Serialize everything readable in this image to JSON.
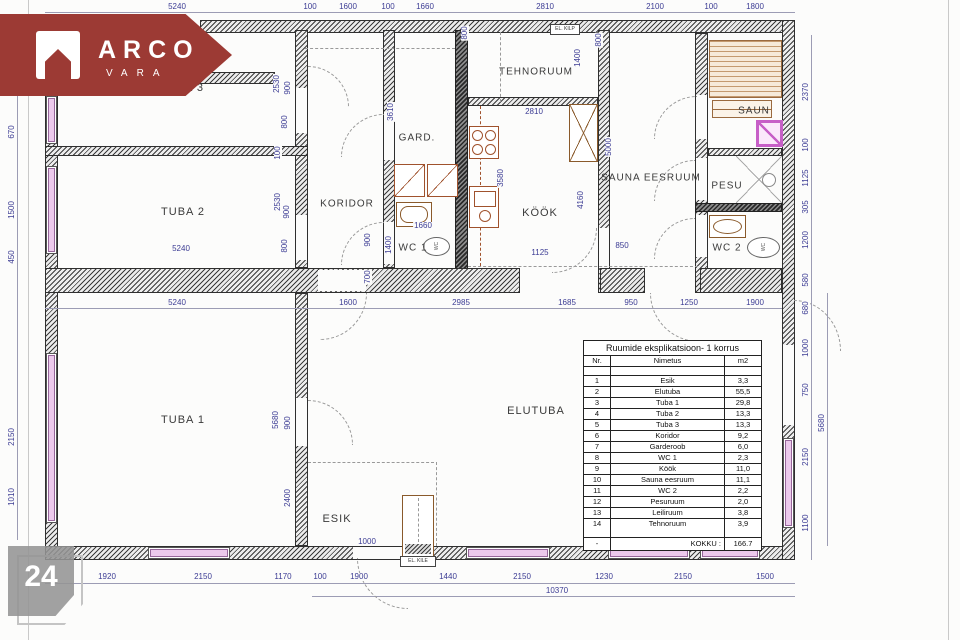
{
  "logo": {
    "brand": "ARCO",
    "sub": "VARA"
  },
  "badge": {
    "number": "24"
  },
  "annotations": {
    "el_kilp": "EL. KILP",
    "el_kile": "EL. KILE",
    "wc1_toilet": "WC",
    "wc2_toilet": "WC"
  },
  "rooms": [
    {
      "label": "TUBA 3",
      "x": 182,
      "y": 88,
      "s": 11
    },
    {
      "label": "TUBA 2",
      "x": 183,
      "y": 212,
      "s": 11
    },
    {
      "label": "TUBA 1",
      "x": 183,
      "y": 420,
      "s": 11
    },
    {
      "label": "ELUTUBA",
      "x": 536,
      "y": 411,
      "s": 11
    },
    {
      "label": "ESIK",
      "x": 337,
      "y": 519,
      "s": 11
    },
    {
      "label": "KORIDOR",
      "x": 347,
      "y": 204,
      "s": 10
    },
    {
      "label": "GARD.",
      "x": 417,
      "y": 138,
      "s": 10
    },
    {
      "label": "WC 1",
      "x": 413,
      "y": 248,
      "s": 10
    },
    {
      "label": "KÖÖK",
      "x": 540,
      "y": 213,
      "s": 11
    },
    {
      "label": "TEHNORUUM",
      "x": 536,
      "y": 72,
      "s": 10
    },
    {
      "label": "SAUNA EESRUUM",
      "x": 651,
      "y": 178,
      "s": 10
    },
    {
      "label": "SAUN",
      "x": 754,
      "y": 111,
      "s": 10
    },
    {
      "label": "PESU",
      "x": 727,
      "y": 186,
      "s": 10
    },
    {
      "label": "WC 2",
      "x": 727,
      "y": 248,
      "s": 10
    }
  ],
  "dimensions": [
    {
      "t": "5240",
      "x": 177,
      "y": 7
    },
    {
      "t": "100",
      "x": 310,
      "y": 7
    },
    {
      "t": "1600",
      "x": 348,
      "y": 7
    },
    {
      "t": "100",
      "x": 388,
      "y": 7
    },
    {
      "t": "1660",
      "x": 425,
      "y": 7
    },
    {
      "t": "2810",
      "x": 545,
      "y": 7
    },
    {
      "t": "2100",
      "x": 655,
      "y": 7
    },
    {
      "t": "100",
      "x": 711,
      "y": 7
    },
    {
      "t": "1800",
      "x": 755,
      "y": 7
    },
    {
      "t": "5240",
      "x": 177,
      "y": 303
    },
    {
      "t": "1600",
      "x": 348,
      "y": 303
    },
    {
      "t": "2985",
      "x": 461,
      "y": 303
    },
    {
      "t": "1685",
      "x": 567,
      "y": 303
    },
    {
      "t": "950",
      "x": 631,
      "y": 303
    },
    {
      "t": "1250",
      "x": 689,
      "y": 303
    },
    {
      "t": "1900",
      "x": 755,
      "y": 303
    },
    {
      "t": "1920",
      "x": 107,
      "y": 577
    },
    {
      "t": "2150",
      "x": 203,
      "y": 577
    },
    {
      "t": "1170",
      "x": 283,
      "y": 577
    },
    {
      "t": "100",
      "x": 320,
      "y": 577
    },
    {
      "t": "1900",
      "x": 359,
      "y": 577
    },
    {
      "t": "1440",
      "x": 448,
      "y": 577
    },
    {
      "t": "2150",
      "x": 522,
      "y": 577
    },
    {
      "t": "1230",
      "x": 604,
      "y": 577
    },
    {
      "t": "2150",
      "x": 683,
      "y": 577
    },
    {
      "t": "1500",
      "x": 765,
      "y": 577
    },
    {
      "t": "10370",
      "x": 557,
      "y": 591
    },
    {
      "t": "670",
      "x": 12,
      "y": 132,
      "r": 1
    },
    {
      "t": "1500",
      "x": 12,
      "y": 210,
      "r": 1
    },
    {
      "t": "450",
      "x": 12,
      "y": 257,
      "r": 1
    },
    {
      "t": "2150",
      "x": 12,
      "y": 437,
      "r": 1
    },
    {
      "t": "1010",
      "x": 12,
      "y": 497,
      "r": 1
    },
    {
      "t": "2370",
      "x": 806,
      "y": 92,
      "r": 1
    },
    {
      "t": "100",
      "x": 806,
      "y": 145,
      "r": 1
    },
    {
      "t": "1125",
      "x": 806,
      "y": 178,
      "r": 1
    },
    {
      "t": "305",
      "x": 806,
      "y": 207,
      "r": 1
    },
    {
      "t": "1200",
      "x": 806,
      "y": 240,
      "r": 1
    },
    {
      "t": "580",
      "x": 806,
      "y": 280,
      "r": 1
    },
    {
      "t": "680",
      "x": 806,
      "y": 308,
      "r": 1
    },
    {
      "t": "1000",
      "x": 806,
      "y": 348,
      "r": 1
    },
    {
      "t": "750",
      "x": 806,
      "y": 390,
      "r": 1
    },
    {
      "t": "2150",
      "x": 806,
      "y": 457,
      "r": 1
    },
    {
      "t": "1100",
      "x": 806,
      "y": 523,
      "r": 1
    },
    {
      "t": "5680",
      "x": 822,
      "y": 423,
      "r": 1
    },
    {
      "t": "2530",
      "x": 277,
      "y": 84,
      "r": 1
    },
    {
      "t": "900",
      "x": 288,
      "y": 88,
      "r": 1
    },
    {
      "t": "800",
      "x": 285,
      "y": 122,
      "r": 1
    },
    {
      "t": "100",
      "x": 278,
      "y": 153,
      "r": 1
    },
    {
      "t": "2530",
      "x": 278,
      "y": 202,
      "r": 1
    },
    {
      "t": "900",
      "x": 287,
      "y": 212,
      "r": 1
    },
    {
      "t": "800",
      "x": 285,
      "y": 246,
      "r": 1
    },
    {
      "t": "5680",
      "x": 276,
      "y": 420,
      "r": 1
    },
    {
      "t": "900",
      "x": 288,
      "y": 423,
      "r": 1
    },
    {
      "t": "2400",
      "x": 288,
      "y": 498,
      "r": 1
    },
    {
      "t": "900",
      "x": 368,
      "y": 240,
      "r": 1
    },
    {
      "t": "700",
      "x": 368,
      "y": 277,
      "r": 1
    },
    {
      "t": "1400",
      "x": 389,
      "y": 245,
      "r": 1
    },
    {
      "t": "3610",
      "x": 391,
      "y": 112,
      "r": 1
    },
    {
      "t": "3580",
      "x": 501,
      "y": 178,
      "r": 1
    },
    {
      "t": "4160",
      "x": 581,
      "y": 200,
      "r": 1
    },
    {
      "t": "5000",
      "x": 609,
      "y": 147,
      "r": 1
    },
    {
      "t": "1400",
      "x": 578,
      "y": 58,
      "r": 1
    },
    {
      "t": "800",
      "x": 465,
      "y": 33,
      "r": 1
    },
    {
      "t": "800",
      "x": 599,
      "y": 40,
      "r": 1
    },
    {
      "t": "1660",
      "x": 423,
      "y": 226
    },
    {
      "t": "1125",
      "x": 540,
      "y": 253
    },
    {
      "t": "2810",
      "x": 534,
      "y": 112
    },
    {
      "t": "850",
      "x": 622,
      "y": 246
    },
    {
      "t": "1000",
      "x": 367,
      "y": 542
    },
    {
      "t": "5240",
      "x": 181,
      "y": 249
    }
  ],
  "table": {
    "title": "Ruumide eksplikatsioon- 1 korrus",
    "headers": [
      "Nr.",
      "Nimetus",
      "m2"
    ],
    "rows": [
      [
        "1",
        "Esik",
        "3,3"
      ],
      [
        "2",
        "Elutuba",
        "55,5"
      ],
      [
        "3",
        "Tuba 1",
        "29,8"
      ],
      [
        "4",
        "Tuba 2",
        "13,3"
      ],
      [
        "5",
        "Tuba 3",
        "13,3"
      ],
      [
        "6",
        "Koridor",
        "9,2"
      ],
      [
        "7",
        "Garderoob",
        "6,0"
      ],
      [
        "8",
        "WC 1",
        "2,3"
      ],
      [
        "9",
        "Köök",
        "11,0"
      ],
      [
        "10",
        "Sauna eesruum",
        "11,1"
      ],
      [
        "11",
        "WC 2",
        "2,2"
      ],
      [
        "12",
        "Pesuruum",
        "2,0"
      ],
      [
        "13",
        "Leiliruum",
        "3,8"
      ],
      [
        "14",
        "Tehnoruum",
        "3,9"
      ]
    ],
    "total_label": "KOKKU :",
    "total_value": "166.7"
  }
}
